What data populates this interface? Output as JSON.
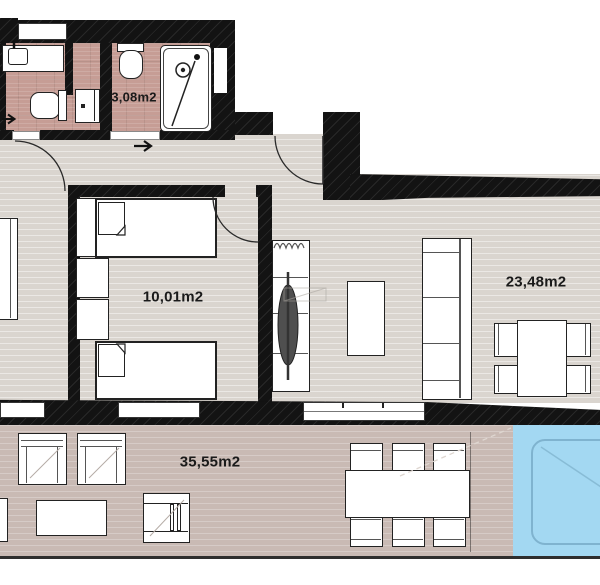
{
  "plan_title": "apartment-floor-plan",
  "rooms": {
    "bathroom": {
      "area_label": "3,08m2"
    },
    "bedroom": {
      "area_label": "10,01m2"
    },
    "living_room": {
      "area_label": "23,48m2"
    },
    "terrace": {
      "area_label": "35,55m2"
    }
  },
  "colors": {
    "wall": "#131313",
    "interior_floor": "#dad5cf",
    "bathroom_floor": "#c69d95",
    "terrace_floor": "#c9bab4",
    "pool_water": "#a3d8f2",
    "pool_inner_line": "#7fb3cf",
    "furniture_outline": "#222222",
    "label_text": "#1a1a1a"
  }
}
